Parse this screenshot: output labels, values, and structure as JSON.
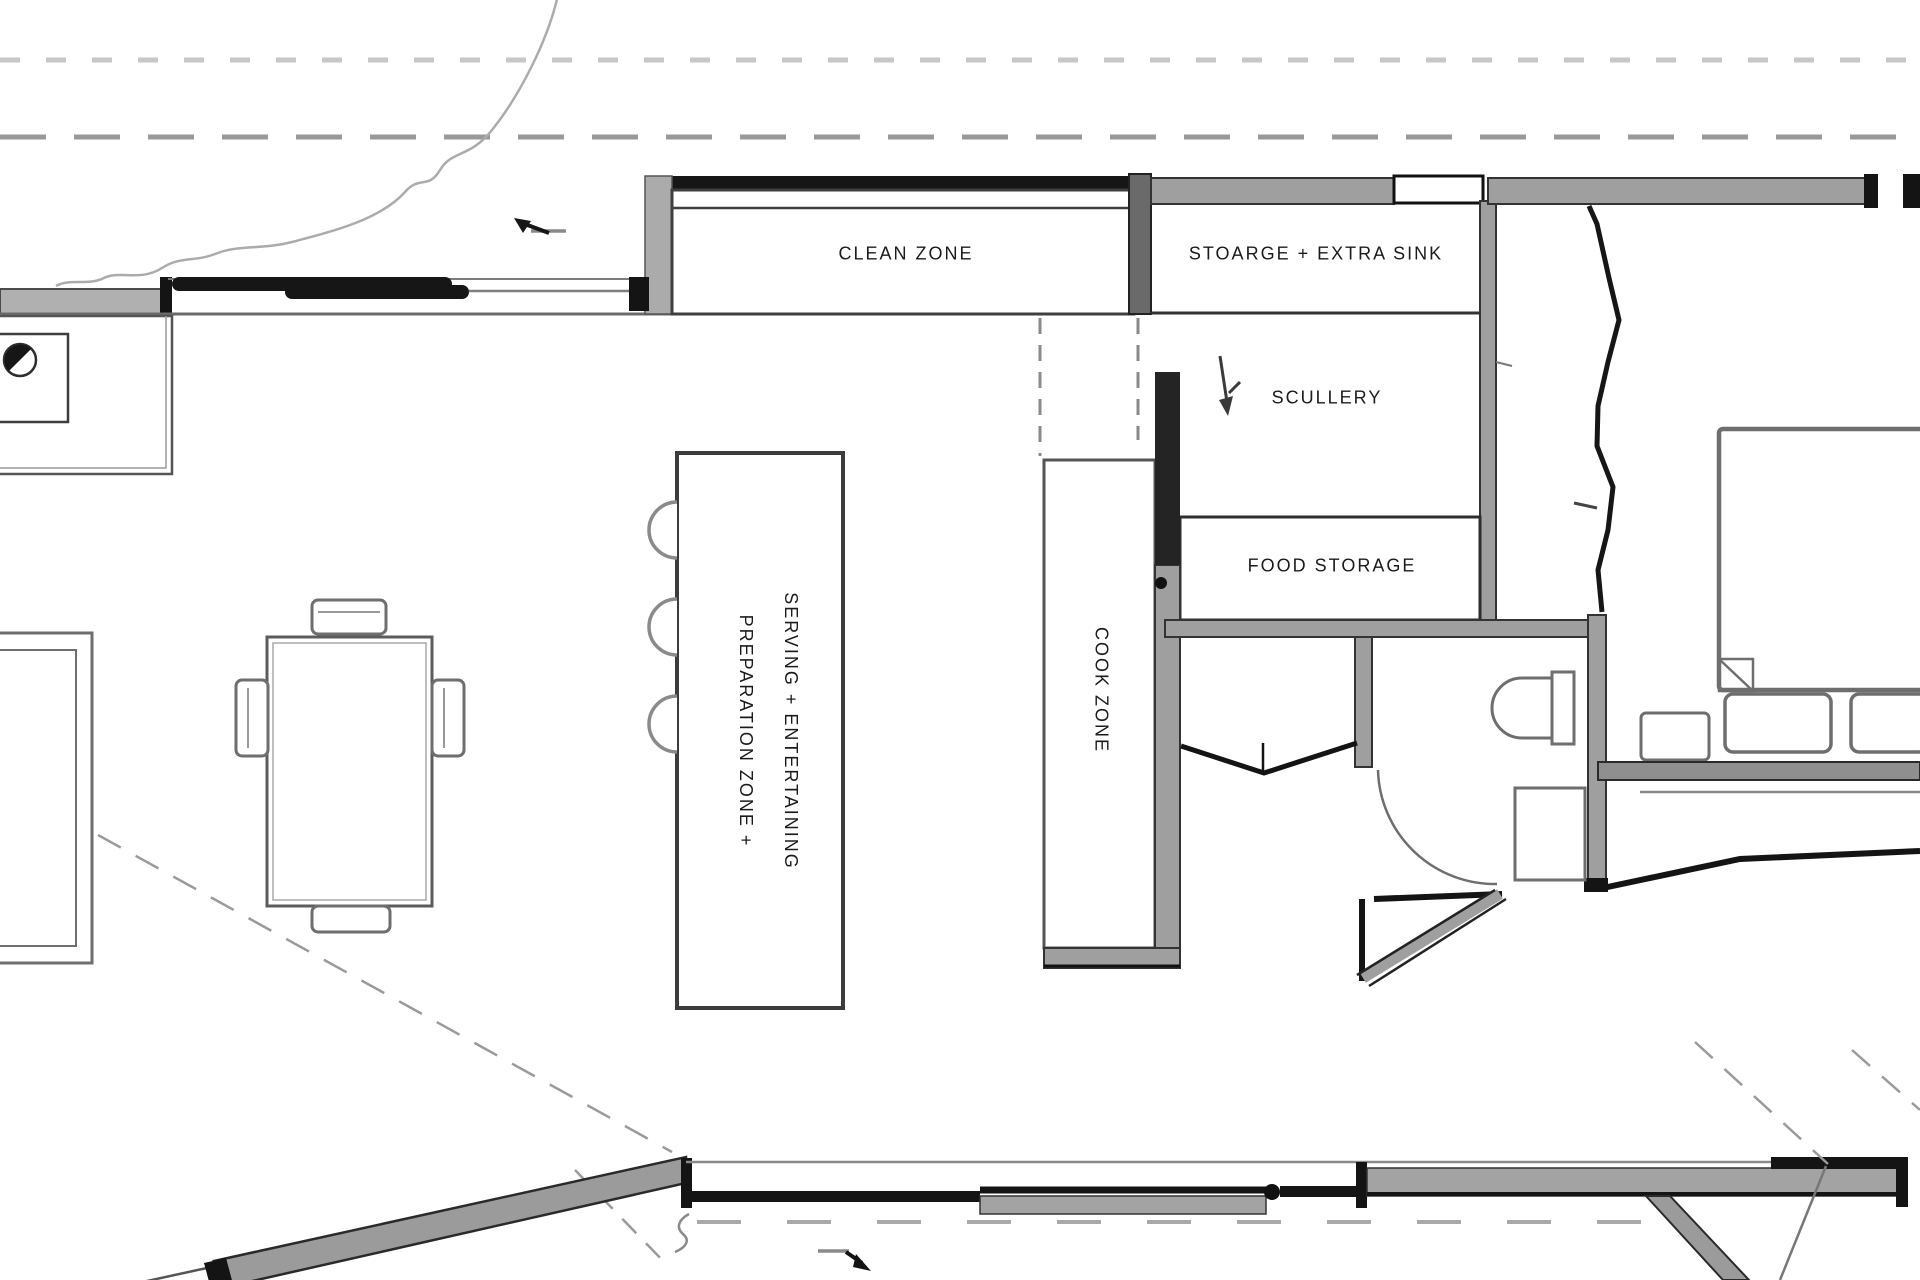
{
  "canvas": {
    "width_px": 1920,
    "height_px": 1280,
    "background": "#ffffff"
  },
  "labels": {
    "clean_zone": "CLEAN ZONE",
    "storage_extra_sink": "STOARGE + EXTRA SINK",
    "scullery": "SCULLERY",
    "food_storage": "FOOD STORAGE",
    "cook_zone": "COOK ZONE",
    "island_serving_line": "SERVING + ENTERTAINING",
    "island_prep_line": "PREPARATION ZONE +"
  },
  "icons": {
    "top_arrow": "arrow-left-icon",
    "scullery_arrow": "arrow-down-icon",
    "bottom_arrow": "arrow-right-icon"
  },
  "style": {
    "text_color": "#1b1b1b",
    "wall_gray": "#9f9f9f",
    "wall_black": "#141414",
    "line_gray": "#8a8a8a",
    "dash_line_light": "#c7c7c7",
    "dash_line_mid": "#999999"
  }
}
